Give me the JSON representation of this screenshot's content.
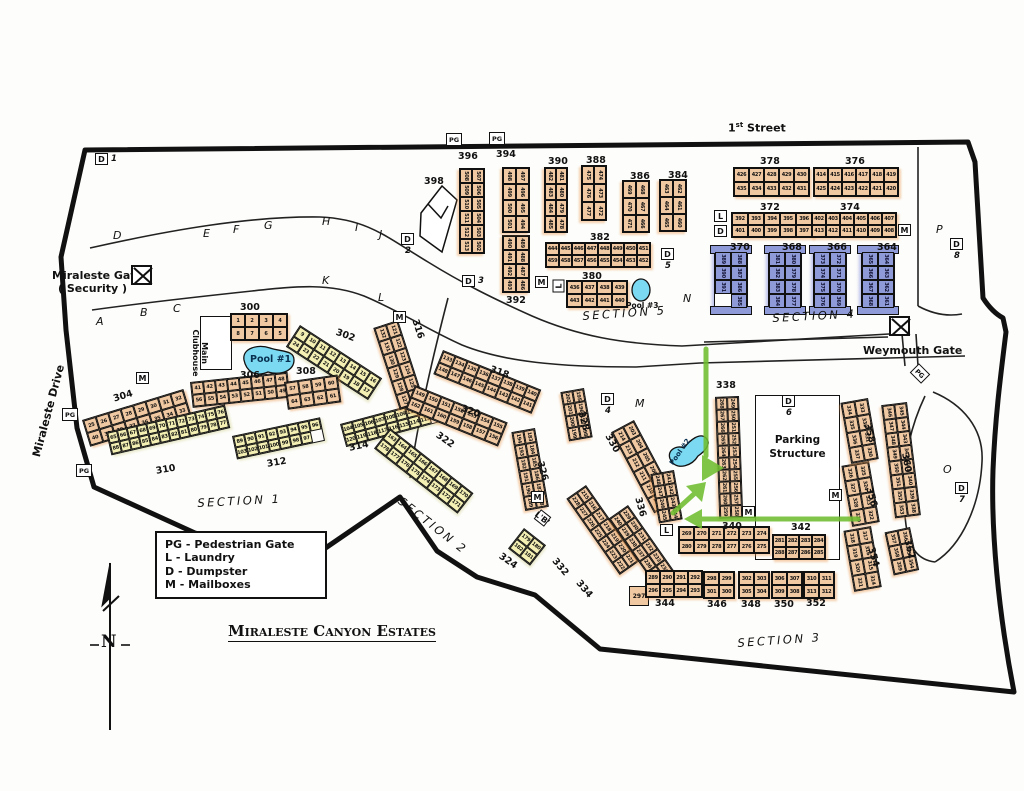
{
  "title": "Miraleste Canyon Estates",
  "legend": {
    "items": [
      "PG - Pedestrian Gate",
      "L - Laundry",
      "D - Dumpster",
      "M - Mailboxes"
    ]
  },
  "labels": {
    "first_street_num": "1",
    "first_street_ord": "st",
    "first_street_name": "Street",
    "miraleste_gate": "Miraleste Gate",
    "miraleste_gate_sub": "( Security )",
    "weymouth_gate": "Weymouth Gate",
    "miraleste_drive": "Miraleste Drive",
    "main_clubhouse": "Main Clubhouse",
    "parking_structure_line1": "Parking",
    "parking_structure_line2": "Structure",
    "compass_north": "N"
  },
  "sections": [
    {
      "label": "Section 1"
    },
    {
      "label": "Section 2"
    },
    {
      "label": "Section 3"
    },
    {
      "label": "Section 4"
    },
    {
      "label": "Section 5"
    }
  ],
  "pools": [
    {
      "label": "Pool #1"
    },
    {
      "label": "Pool #2"
    },
    {
      "label": "Pool #3"
    }
  ],
  "road_letters": [
    "A",
    "B",
    "C",
    "D",
    "E",
    "F",
    "G",
    "H",
    "I",
    "J",
    "K",
    "L",
    "M",
    "N",
    "O",
    "P"
  ],
  "icon_legend": {
    "pedestrian_gate": "PG",
    "laundry": "L",
    "dumpster": "D",
    "mailboxes": "M"
  },
  "dumpsters": [
    "1",
    "2",
    "3",
    "4",
    "5",
    "6",
    "7",
    "8"
  ],
  "standalone_unit": "297",
  "laundry_b_label": "'B'",
  "colors": {
    "building_tan": "#f0c8a2",
    "building_yellow": "#f4f0b4",
    "building_blue": "#8f9bd8",
    "pool_blue": "#7cd9f2",
    "arrow_green": "#6fbe30"
  },
  "buildings": [
    {
      "id": "300",
      "units": "1–8",
      "rows": [
        [
          1,
          2,
          3,
          4
        ],
        [
          8,
          7,
          6,
          5
        ]
      ]
    },
    {
      "id": "302",
      "units": "9–24",
      "rows": [
        [
          9,
          10,
          11,
          12,
          13,
          14,
          15,
          16
        ],
        [
          24,
          23,
          22,
          21,
          20,
          19,
          18,
          17
        ]
      ]
    },
    {
      "id": "304",
      "units": "25–40",
      "rows": [
        [
          25,
          26,
          27,
          28,
          29,
          30,
          31,
          32
        ],
        [
          40,
          39,
          38,
          37,
          36,
          35,
          34,
          33
        ]
      ]
    },
    {
      "id": "306",
      "units": "41–56",
      "rows": [
        [
          41,
          42,
          43,
          44,
          45,
          46,
          47,
          48
        ],
        [
          56,
          55,
          54,
          53,
          52,
          51,
          50,
          49
        ]
      ]
    },
    {
      "id": "308",
      "units": "57–64",
      "rows": [
        [
          57,
          58,
          59,
          60
        ],
        [
          64,
          63,
          62,
          61
        ]
      ]
    },
    {
      "id": "310",
      "units": "65–88",
      "rows": [
        [
          65,
          66,
          67,
          68,
          69,
          70,
          71,
          72,
          73,
          74,
          75,
          76
        ],
        [
          88,
          87,
          86,
          85,
          84,
          83,
          82,
          81,
          80,
          79,
          78,
          77
        ]
      ]
    },
    {
      "id": "312",
      "units": "89–103",
      "rows": [
        [
          89,
          90,
          91,
          92,
          93,
          94,
          95,
          96
        ],
        [
          103,
          102,
          101,
          100,
          99,
          98,
          97
        ]
      ]
    },
    {
      "id": "314",
      "units": "104–120",
      "rows": [
        [
          104,
          105,
          106,
          107,
          108,
          109,
          110,
          111,
          112
        ],
        [
          120,
          119,
          118,
          117,
          116,
          115,
          114,
          113
        ]
      ]
    },
    {
      "id": "316",
      "units": "121–132",
      "rows": [
        [
          121,
          122,
          123,
          124,
          125,
          126
        ],
        [
          132,
          131,
          130,
          129,
          128,
          127
        ]
      ]
    },
    {
      "id": "318",
      "units": "133–148",
      "rows": [
        [
          133,
          134,
          135,
          136,
          137,
          138,
          139,
          140
        ],
        [
          148,
          147,
          146,
          145,
          144,
          143,
          142,
          141
        ]
      ]
    },
    {
      "id": "320",
      "units": "149–162",
      "rows": [
        [
          149,
          150,
          151,
          152,
          153,
          154,
          155
        ],
        [
          162,
          161,
          160,
          159,
          158,
          157,
          156
        ]
      ]
    },
    {
      "id": "322",
      "units": "163–178",
      "rows": [
        [
          163,
          164,
          165,
          166,
          167,
          168,
          169,
          170
        ],
        [
          178,
          177,
          176,
          175,
          174,
          173,
          172,
          171
        ]
      ]
    },
    {
      "id": "324",
      "units": "179–182",
      "rows": [
        [
          179,
          180
        ],
        [
          182,
          181
        ]
      ]
    },
    {
      "id": "326",
      "units": "183–194",
      "rows": [
        [
          183,
          184,
          185,
          186,
          187,
          188
        ],
        [
          194,
          193,
          192,
          191,
          190,
          189
        ]
      ]
    },
    {
      "id": "328",
      "units": "195–202",
      "rows": [
        [
          195,
          196,
          197,
          198
        ],
        [
          202,
          201,
          200,
          199
        ]
      ]
    },
    {
      "id": "330",
      "units": "203–214",
      "rows": [
        [
          203,
          204,
          205,
          206,
          207,
          208
        ],
        [
          214,
          213,
          212,
          211,
          210,
          209
        ]
      ]
    },
    {
      "id": "332",
      "units": "215–228",
      "rows": [
        [
          215,
          216,
          217,
          218,
          219,
          220,
          221
        ],
        [
          228,
          227,
          226,
          225,
          224,
          223,
          222
        ]
      ]
    },
    {
      "id": "334",
      "units": "229–240",
      "rows": [
        [
          229,
          230,
          231,
          232,
          233,
          234
        ],
        [
          240,
          239,
          238,
          237,
          236,
          235
        ]
      ]
    },
    {
      "id": "336",
      "units": "241–248",
      "rows": [
        [
          241,
          242,
          243,
          244
        ],
        [
          248,
          247,
          246,
          245
        ]
      ]
    },
    {
      "id": "338",
      "units": "249–268",
      "rows": [
        [
          249,
          250,
          251,
          252,
          253,
          254,
          255,
          256,
          257,
          258
        ],
        [
          268,
          267,
          266,
          265,
          264,
          263,
          262,
          261,
          260,
          259
        ]
      ]
    },
    {
      "id": "340",
      "units": "269–280",
      "rows": [
        [
          269,
          270,
          271,
          272,
          273,
          274
        ],
        [
          280,
          279,
          278,
          277,
          276,
          275
        ]
      ]
    },
    {
      "id": "342",
      "units": "281–288",
      "rows": [
        [
          281,
          282,
          283,
          284
        ],
        [
          288,
          287,
          286,
          285
        ]
      ]
    },
    {
      "id": "344",
      "units": "289–296",
      "rows": [
        [
          289,
          290,
          291,
          292
        ],
        [
          296,
          295,
          294,
          293
        ]
      ]
    },
    {
      "id": "346",
      "units": "298–301",
      "rows": [
        [
          298,
          299
        ],
        [
          301,
          300
        ]
      ]
    },
    {
      "id": "348",
      "units": "302–305",
      "rows": [
        [
          302,
          303
        ],
        [
          305,
          304
        ]
      ]
    },
    {
      "id": "350",
      "units": "306–309",
      "rows": [
        [
          306,
          307
        ],
        [
          309,
          308
        ]
      ]
    },
    {
      "id": "352",
      "units": "310–313",
      "rows": [
        [
          310,
          311
        ],
        [
          313,
          312
        ]
      ]
    },
    {
      "id": "354",
      "units": "314–321",
      "rows": [
        [
          317,
          316,
          315,
          314
        ],
        [
          318,
          319,
          320,
          321
        ]
      ]
    },
    {
      "id": "356",
      "units": "322–329",
      "rows": [
        [
          325,
          324,
          323,
          322
        ],
        [
          326,
          327,
          328,
          329
        ]
      ]
    },
    {
      "id": "358",
      "units": "330–337",
      "rows": [
        [
          333,
          332,
          331,
          330
        ],
        [
          334,
          335,
          336,
          337
        ]
      ]
    },
    {
      "id": "360",
      "units": "338–353",
      "rows": [
        [
          345,
          344,
          343,
          342,
          341,
          340,
          339,
          338
        ],
        [
          346,
          347,
          348,
          349,
          350,
          351,
          352,
          353
        ]
      ]
    },
    {
      "id": "362",
      "units": "354–359",
      "rows": [
        [
          356,
          355,
          354
        ],
        [
          357,
          358,
          359
        ]
      ]
    },
    {
      "id": "364",
      "units": "361–368",
      "rows": [
        [
          364,
          363,
          362,
          361
        ],
        [
          365,
          366,
          367,
          368
        ]
      ]
    },
    {
      "id": "366",
      "units": "369–376",
      "rows": [
        [
          372,
          371,
          370,
          369
        ],
        [
          373,
          374,
          375,
          376
        ]
      ]
    },
    {
      "id": "368",
      "units": "377–384",
      "rows": [
        [
          380,
          379,
          378,
          377
        ],
        [
          381,
          382,
          383,
          384
        ]
      ]
    },
    {
      "id": "370",
      "units": "385–391",
      "rows": [
        [
          388,
          387,
          386,
          385
        ],
        [
          389,
          390,
          391
        ]
      ]
    },
    {
      "id": "372",
      "units": "392–401",
      "rows": [
        [
          392,
          393,
          394,
          395,
          396
        ],
        [
          401,
          400,
          399,
          398,
          397
        ]
      ]
    },
    {
      "id": "374",
      "units": "402–413",
      "rows": [
        [
          402,
          403,
          404,
          405,
          406,
          407
        ],
        [
          413,
          412,
          411,
          410,
          409,
          408
        ]
      ]
    },
    {
      "id": "376",
      "units": "414–425",
      "rows": [
        [
          414,
          415,
          416,
          417,
          418,
          419
        ],
        [
          425,
          424,
          423,
          422,
          421,
          420
        ]
      ]
    },
    {
      "id": "378",
      "units": "426–435",
      "rows": [
        [
          426,
          427,
          428,
          429,
          430
        ],
        [
          435,
          434,
          433,
          432,
          431
        ]
      ]
    },
    {
      "id": "380",
      "units": "436–443",
      "rows": [
        [
          436,
          437,
          438,
          439
        ],
        [
          443,
          442,
          441,
          440
        ]
      ]
    },
    {
      "id": "382",
      "units": "444–459",
      "rows": [
        [
          444,
          445,
          446,
          447,
          448,
          449,
          450,
          451
        ],
        [
          459,
          458,
          457,
          456,
          455,
          454,
          453,
          452
        ]
      ]
    },
    {
      "id": "384",
      "units": "460–465",
      "rows": [
        [
          462,
          461,
          460
        ],
        [
          463,
          464,
          465
        ]
      ]
    },
    {
      "id": "386",
      "units": "466–471",
      "rows": [
        [
          468,
          467,
          466
        ],
        [
          469,
          470,
          471
        ]
      ]
    },
    {
      "id": "388",
      "units": "472–477",
      "rows": [
        [
          474,
          473,
          472
        ],
        [
          475,
          476,
          477
        ]
      ]
    },
    {
      "id": "390",
      "units": "478–485",
      "rows": [
        [
          481,
          480,
          479,
          478
        ],
        [
          482,
          483,
          484,
          485
        ]
      ]
    },
    {
      "id": "392",
      "units": "486–493",
      "rows": [
        [
          489,
          488,
          487,
          486
        ],
        [
          490,
          491,
          492,
          493
        ]
      ]
    },
    {
      "id": "394",
      "units": "494–501",
      "rows": [
        [
          497,
          496,
          495,
          494
        ],
        [
          498,
          499,
          500,
          501
        ]
      ]
    },
    {
      "id": "396",
      "units": "502–513",
      "rows": [
        [
          507,
          506,
          505,
          504,
          503,
          502
        ],
        [
          508,
          509,
          510,
          511,
          512,
          513
        ]
      ]
    },
    {
      "id": "398",
      "units": "",
      "rows": []
    }
  ]
}
